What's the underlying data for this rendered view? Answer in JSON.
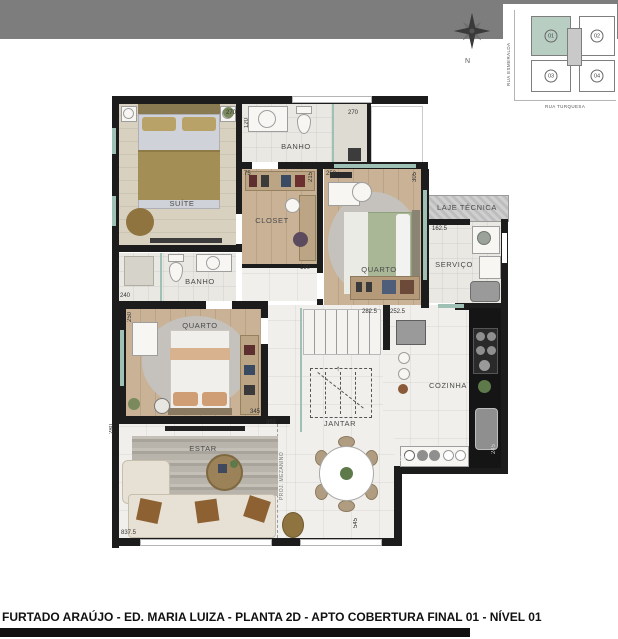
{
  "colors": {
    "wall": "#1c1c1c",
    "accent-teal": "#9fc0b5",
    "band": "#7d7d7d",
    "highlight-unit": "#b9cec3",
    "wood": "#c9b295"
  },
  "header": {
    "compass_n": "N"
  },
  "key_plan": {
    "street_left": "RUA ESMERALDA",
    "street_bottom": "RUA TURQUESA",
    "units": [
      "01",
      "02",
      "03",
      "04"
    ]
  },
  "plan": {
    "rooms": [
      {
        "label": "SUÍTE"
      },
      {
        "label": "BANHO"
      },
      {
        "label": "CLOSET"
      },
      {
        "label": "QUARTO"
      },
      {
        "label": "LAJE TÉCNICA"
      },
      {
        "label": "SERVIÇO"
      },
      {
        "label": "BANHO"
      },
      {
        "label": "QUARTO"
      },
      {
        "label": "COZINHA"
      },
      {
        "label": "JANTAR"
      },
      {
        "label": "ESTAR"
      }
    ],
    "dimensions": [
      "270",
      "270",
      "120",
      "250",
      "75",
      "215",
      "305",
      "162.5",
      "190",
      "240",
      "250",
      "345",
      "355",
      "282.5",
      "252.5",
      "280",
      "837.5",
      "545",
      "130",
      "245"
    ],
    "annotations": [
      {
        "text": "PROJ. MEZANINO"
      }
    ]
  },
  "footer": {
    "caption": "FURTADO ARAÚJO - ED. MARIA LUIZA - PLANTA 2D - APTO COBERTURA FINAL 01 - NÍVEL 01"
  }
}
